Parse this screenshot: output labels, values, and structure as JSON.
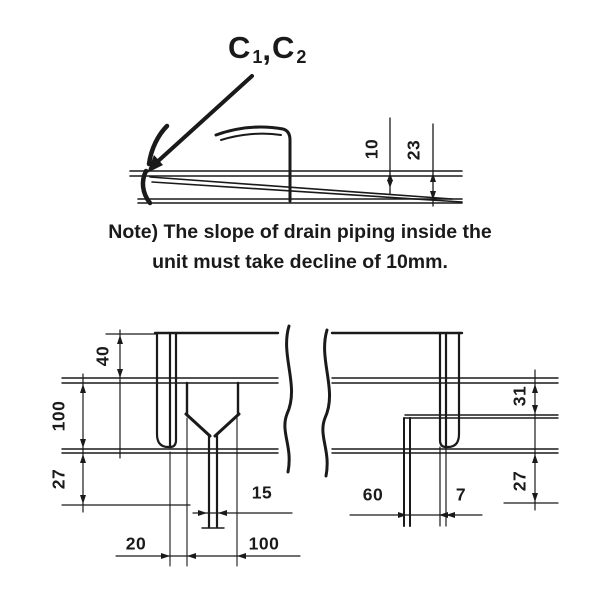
{
  "colors": {
    "ink": "#1a1a1a",
    "background": "#ffffff"
  },
  "callout": {
    "c1": "C",
    "sub1": "1",
    "separator": ",",
    "c2": "C",
    "sub2": "2"
  },
  "top_diagram": {
    "dim_decline": "10",
    "dim_total": "23"
  },
  "note": {
    "line1": "Note) The slope of drain piping inside the",
    "line2": "unit must take decline of 10mm."
  },
  "bottom_diagram": {
    "dim_top_left": "40",
    "dim_left_upper": "100",
    "dim_left_lower": "27",
    "dim_bottom_small": "20",
    "dim_spout_width": "15",
    "dim_funnel_width": "100",
    "dim_right_offset": "60",
    "dim_right_small": "7",
    "dim_right_upper": "31",
    "dim_right_lower": "27"
  }
}
